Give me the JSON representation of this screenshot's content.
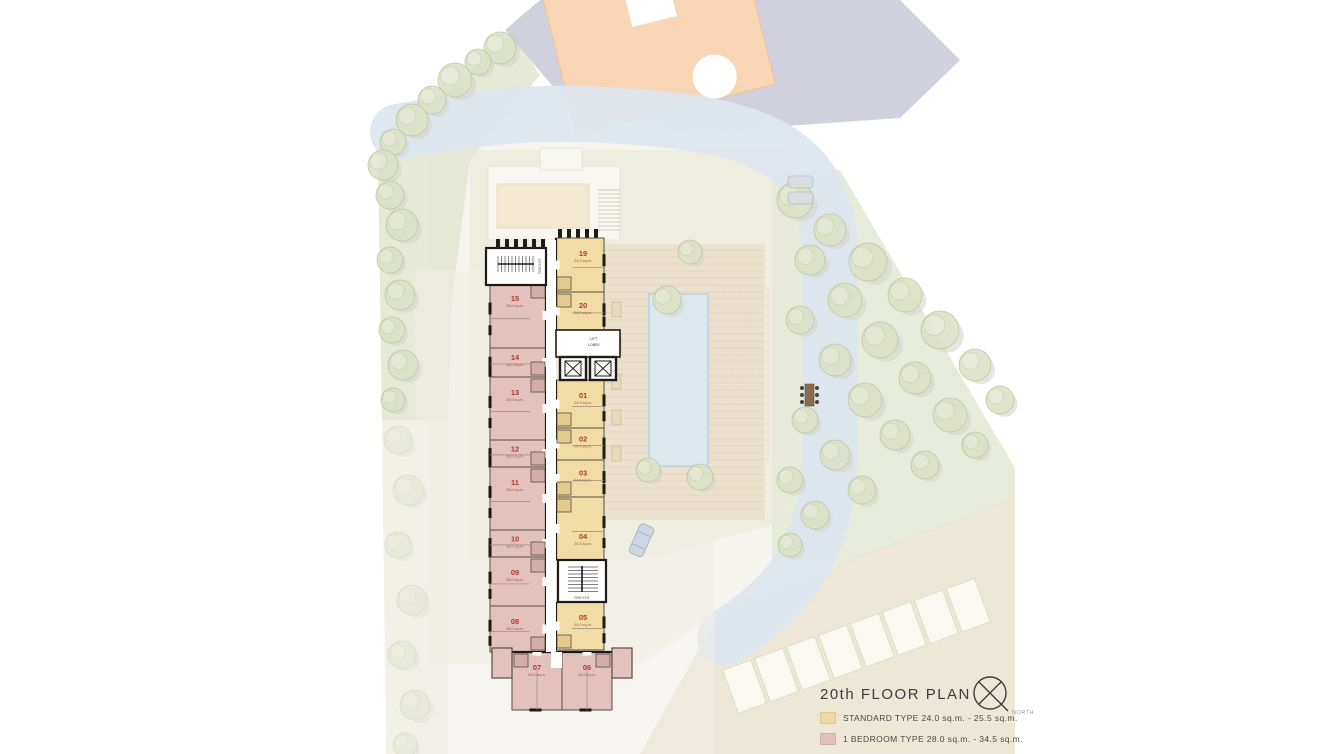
{
  "title": "20th FLOOR PLAN",
  "north_label": "NORTH",
  "legend": {
    "items": [
      {
        "label": "STANDARD TYPE 24.0 sq.m. - 25.5 sq.m.",
        "color": "#eed9a2",
        "type": "standard"
      },
      {
        "label": "1 BEDROOM TYPE 28.0 sq.m. - 34.5 sq.m.",
        "color": "#e0c0b8",
        "type": "1bedroom"
      }
    ]
  },
  "plan_labels": {
    "lift_line1": "LIFT",
    "lift_line2": "LOBBY",
    "fire_exit_top": "FIRE EXIT",
    "fire_exit_mid": "FIRE EXIT"
  },
  "units": [
    {
      "number": "19",
      "area": "24.0 sq.m.",
      "type": "standard"
    },
    {
      "number": "20",
      "area": "24.0 sq.m.",
      "type": "standard"
    },
    {
      "number": "01",
      "area": "24.0 sq.m.",
      "type": "standard"
    },
    {
      "number": "02",
      "area": "24.0 sq.m.",
      "type": "standard"
    },
    {
      "number": "03",
      "area": "24.0 sq.m.",
      "type": "standard"
    },
    {
      "number": "04",
      "area": "25.5 sq.m.",
      "type": "standard"
    },
    {
      "number": "05",
      "area": "24.0 sq.m.",
      "type": "standard"
    },
    {
      "number": "15",
      "area": "28.0 sq.m.",
      "type": "1bedroom"
    },
    {
      "number": "14",
      "area": "28.0 sq.m.",
      "type": "1bedroom"
    },
    {
      "number": "13",
      "area": "28.0 sq.m.",
      "type": "1bedroom"
    },
    {
      "number": "12",
      "area": "28.0 sq.m.",
      "type": "1bedroom"
    },
    {
      "number": "11",
      "area": "28.0 sq.m.",
      "type": "1bedroom"
    },
    {
      "number": "10",
      "area": "28.0 sq.m.",
      "type": "1bedroom"
    },
    {
      "number": "09",
      "area": "28.0 sq.m.",
      "type": "1bedroom"
    },
    {
      "number": "08",
      "area": "28.0 sq.m.",
      "type": "1bedroom"
    },
    {
      "number": "07",
      "area": "34.5 sq.m.",
      "type": "1bedroom"
    },
    {
      "number": "06",
      "area": "34.5 sq.m.",
      "type": "1bedroom"
    }
  ],
  "colors": {
    "standard": "#f0dca4",
    "standard_pod": "#e4cb8d",
    "one_bedroom": "#e2c2ba",
    "one_bedroom_pod": "#d4aea6",
    "unit_number": "#b5382d",
    "unit_area": "#9c5a50",
    "wall": "#1e1a17",
    "wall_light": "#554c45"
  }
}
